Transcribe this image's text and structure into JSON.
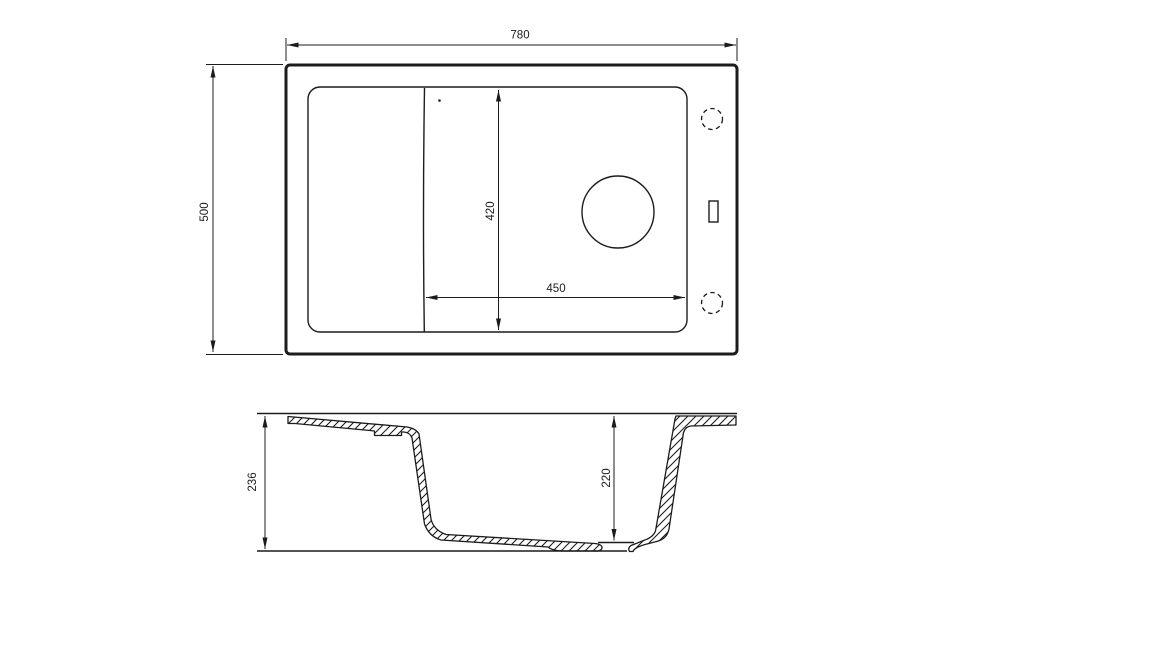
{
  "drawing": {
    "description": "sink-technical-drawing",
    "top_view": {
      "overall_width": "780",
      "overall_depth": "500",
      "bowl_depth": "420",
      "bowl_width": "450"
    },
    "section_view": {
      "overall_height": "236",
      "bowl_height": "220"
    },
    "colors": {
      "line": "#1c1c1c",
      "background": "#ffffff"
    }
  }
}
